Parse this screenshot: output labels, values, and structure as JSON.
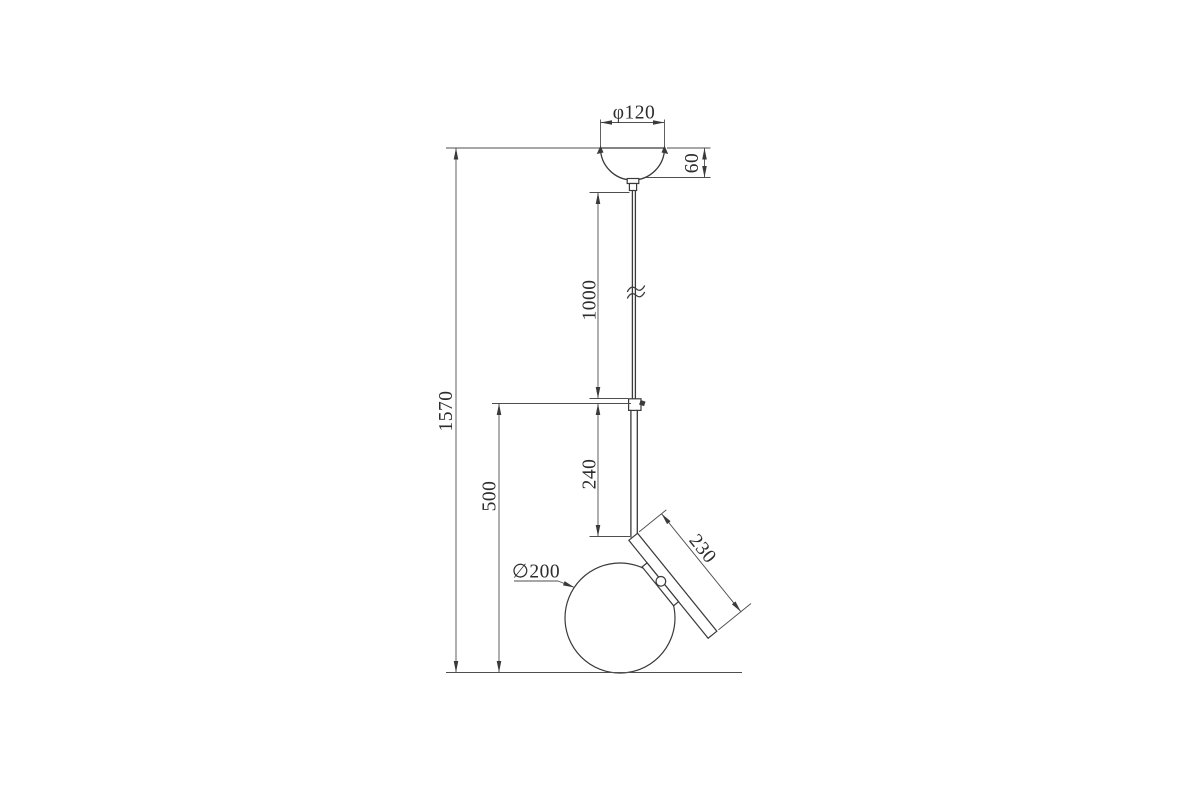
{
  "drawing": {
    "subject": "pendant-lamp-dimension-drawing",
    "units": "mm",
    "background": "#ffffff",
    "line_color": "#3a3a3a",
    "dimension_line_color": "#4e4e4e",
    "text_color": "#2d2d2d",
    "dimensions": {
      "canopy_diameter": {
        "label": "φ120",
        "value": 120
      },
      "canopy_height": {
        "label": "60",
        "value": 60
      },
      "cable_length": {
        "label": "1000",
        "value": 1000
      },
      "total_height": {
        "label": "1570",
        "value": 1570
      },
      "rod_length": {
        "label": "240",
        "value": 240
      },
      "arm_length": {
        "label": "230",
        "value": 230
      },
      "globe_diameter": {
        "label": "∅200",
        "value": 200
      },
      "lower_section_height": {
        "label": "500",
        "value": 500
      }
    }
  }
}
